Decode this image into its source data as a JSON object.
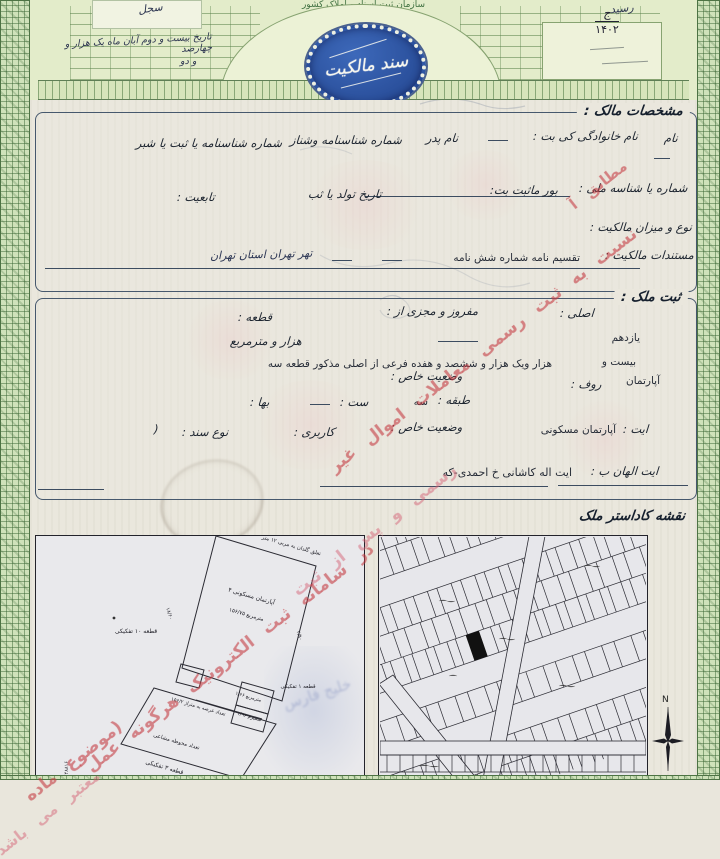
{
  "header": {
    "org_title": "سازمان ثبت اسناد و املاک کشور",
    "emblem_text": "سند مالکیت",
    "series_letter": "ج",
    "series_year": "۱۴۰۲",
    "hw_plaque_word": "سجل",
    "hw_date_line1": "تاریخ بیست و دوم آبان ماه یک هزار و چهارصد",
    "hw_date_line2": "و دو",
    "hw_receipt": "رسید"
  },
  "owner": {
    "title": "مشخصات مالک :",
    "f_name": "نام",
    "f_family": "نام خانوادگی کی بت :",
    "f_father": "نام پدر",
    "f_id1": "شماره شناسنامه وشناز",
    "f_id2": "شماره شناسنامه یا ثبت یا شبر",
    "f_national_id": "شماره یا شناسه ملی :",
    "f_registered": "بور ماثبت بت:",
    "f_birth": "تاریخ تولد یا ثب",
    "f_nationality": "تابعیت :",
    "f_ownership_type": "نوع و میزان مالکیت :",
    "f_docs": "مستندات مالکیت :",
    "docs_value": "تقسیم نامه شماره شش نامه",
    "docs_handwritten": "تهر تهران استان تهران"
  },
  "property": {
    "title": "ثبت ملک :",
    "f_main": "اصلی :",
    "f_separated": "مفروز و مجزی از :",
    "f_plot": "قطعه :",
    "v_main": "یازدهم",
    "f_sqm": "هزار و   مترمربع",
    "v_sub": "بیست و",
    "v_sub_long": "هزار ویک هزار و ششصد و هفده فرعی از اصلی مذکور قطعه سه",
    "f_apartment": "آپارتمان",
    "f_roof": "روف :",
    "f_special1": "وضعیت خاص :",
    "f_area": "ست :",
    "f_floor": "طبقه :",
    "v_floor": "سه",
    "f_price": "بها :",
    "f_ait": "ایت :",
    "v_unit_type": "آپارتمان مسکونی",
    "f_special2": "وضعیت خاص :",
    "f_usage": "کاربری :",
    "f_doc_type": "نوع سند :",
    "paren": "(",
    "f_address_label": "ایت الهان ب :",
    "v_address": "ایت اله کاشانی خ احمدی-که"
  },
  "cadastre": {
    "title": "نقشه کاداستر ملک",
    "compass_n": "N",
    "ghost_text": "خلیج فارس",
    "left_map": {
      "side_numbers": "۴۸۸۱۶ ـ ۱۸۵/۱۹۶/۵۲ ـ ۱۰/۱۰۶/۲۱۹ ـ ۱۰۰۰۶",
      "labels": {
        "top_edge": "تعلق گلدان به مربی ۱۲ متر",
        "apartment": "آپارتمان مسکونی ۴",
        "area": "مترمربع ۱۵۶/۷۵",
        "plot10": "قطعه ۱۰ تفکیکی",
        "plot1": "قطعه ۱ تفکیکی",
        "terrace": "مترمربع ۱/۶۶",
        "yard": "تعداد عرصه به متراژ ۱۵۶/۲",
        "shared_yard": "تعداد محوطه مشاعی",
        "plot3": "قطعه ۳ تفکیکی",
        "dim_left": "۱۸/۶۰",
        "dim_right": "۴/۹۰",
        "small1": "سمیرم ۱/۹۶"
      }
    }
  },
  "watermark": {
    "lines": [
      "مطابق آ",
      "نسبت به ثبت رسمی معاملات اموال غیر",
      "رسمی و پس از ثبت",
      "در سامانه ثبت الکترونیک هرگونه عمل",
      "(موضوع ماده",
      "معتبر می باشد"
    ]
  },
  "colors": {
    "emblem_blue": "#2e55a5",
    "border_green": "#7ba06c",
    "watermark_red": "#c43c42",
    "paper": "#eae7dd"
  }
}
